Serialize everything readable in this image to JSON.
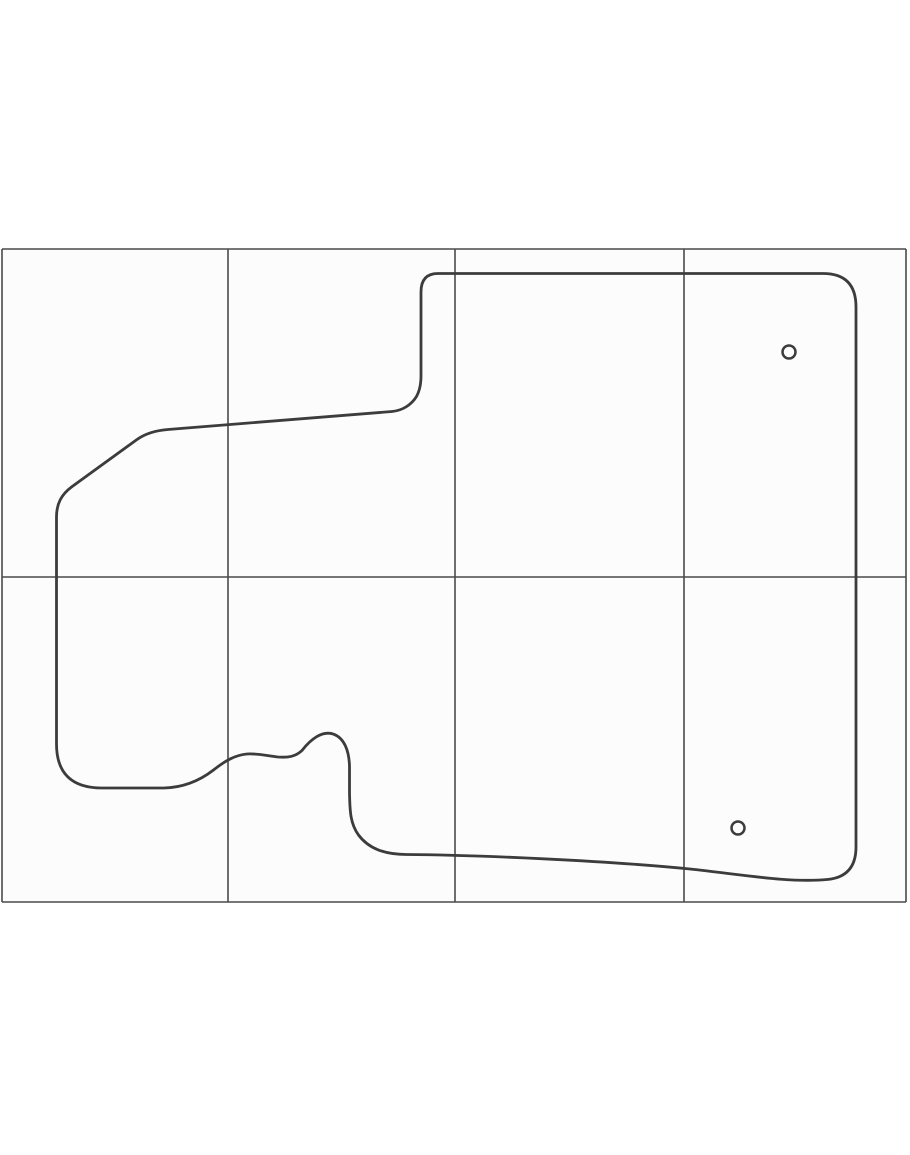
{
  "figure": {
    "title": "floor-mat pattern outline on reference grid",
    "canvas": {
      "width": 910,
      "height": 1155
    },
    "grid": {
      "left": 2,
      "right": 906,
      "top": 249,
      "bottom": 902,
      "v_lines": [
        2,
        228,
        455,
        684,
        906
      ],
      "h_lines": [
        249,
        577,
        902
      ],
      "line_color": "#4a4a4a",
      "line_width": 1.6,
      "cell_fill": "#fcfcfc"
    },
    "outline": {
      "stroke": "#3c3c3c",
      "stroke_width": 2.8,
      "fill": "none",
      "path": "M 438 273.5 H 823 Q 856 273.5 856 307 V 847 Q 856 877 827 879.5 C 790 883 745 875 690 869 C 610 861 480 855 406 854.5 C 385 854.3 369 849 358.5 835 C 350.5 824 349.8 812 349.5 792 L 349.5 766 C 349 751 344.5 738.5 334 734.3 C 322.5 729.8 310.5 739.5 302 750.5 C 295.5 756.5 288.5 757.8 278 757 C 266.5 755.8 257.5 753.2 247 754 C 235.5 755 225.5 760.5 213.5 770 C 199.5 780.8 184 787.5 164 788 L 102 788 Q 56.5 788 56.5 744 V 517 C 56.5 503.5 61.5 494.5 71.5 487 L 137 439.5 C 145.5 433.5 155 430.5 168 429.5 L 392 411.5 C 403 410.5 411.5 404.5 416.5 396.5 C 419.8 390.5 421 384.5 421 376 V 292 Q 421 273.5 438 273.5 Z"
    },
    "holes": {
      "stroke": "#3c3c3c",
      "stroke_width": 2.5,
      "fill": "none",
      "items": [
        {
          "cx": 789,
          "cy": 352,
          "r": 6.5
        },
        {
          "cx": 738,
          "cy": 828,
          "r": 6.5
        }
      ]
    }
  }
}
